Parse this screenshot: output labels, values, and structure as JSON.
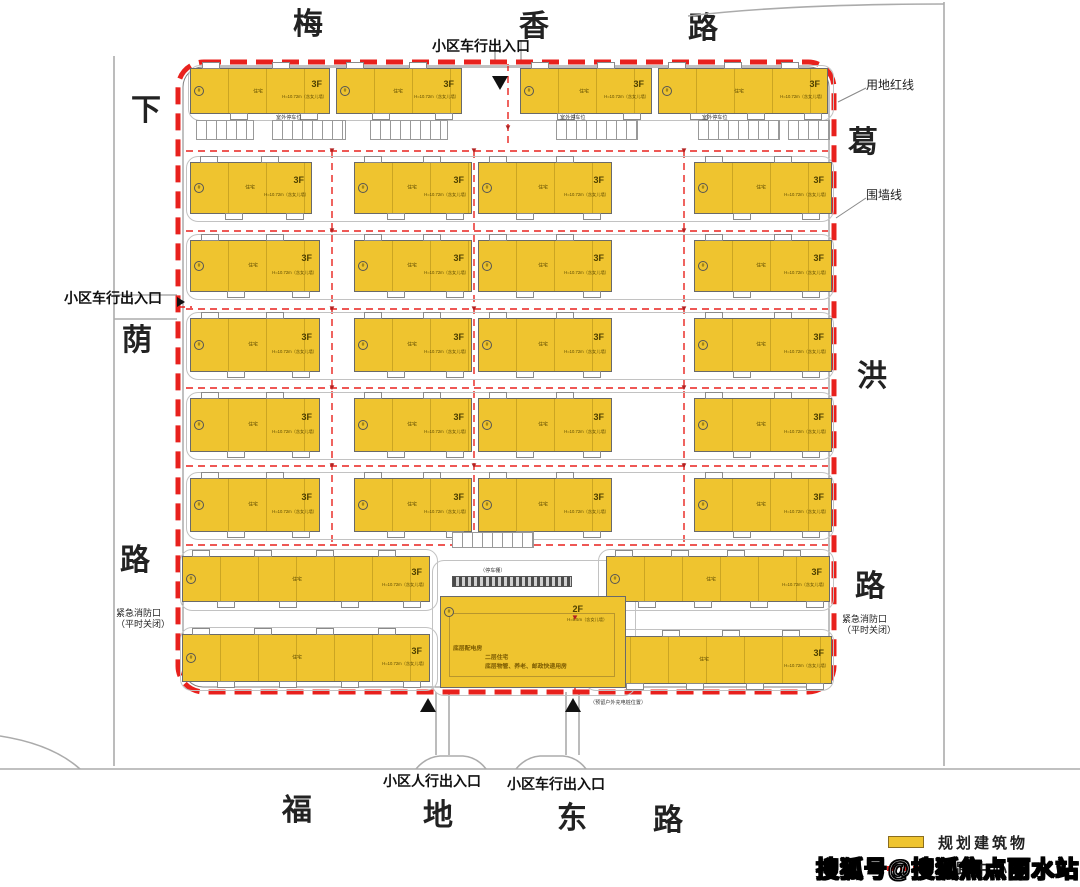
{
  "streets": {
    "top": [
      "梅",
      "香",
      "路"
    ],
    "left": [
      "下",
      "荫",
      "路"
    ],
    "right": [
      "葛",
      "洪",
      "路"
    ],
    "bottom": [
      "福",
      "地",
      "东",
      "路"
    ]
  },
  "annotations": {
    "entrance_vehicle_top": "小区车行出入口",
    "entrance_vehicle_left": "小区车行出入口",
    "entrance_pedestrian_bottom": "小区人行出入口",
    "entrance_vehicle_bottom": "小区车行出入口",
    "land_red_line": "用地红线",
    "wall_line": "围墙线",
    "emergency_exit": "紧急消防口",
    "emergency_exit_note": "（平时关闭）",
    "carport": "（停车棚）",
    "outdoor_parking": "室外停车位",
    "ev_charging": "（预留户外充电桩位置）"
  },
  "building_defaults": {
    "floors": "3F",
    "height": "H=10.72m（含女儿墙）",
    "type": "住宅",
    "marker": "#"
  },
  "central_building": {
    "floors": "2F",
    "height": "H=8.5m（含女儿墙）",
    "text1": "底层配电房",
    "text2": "二层住宅",
    "text3": "底层物管、养老、邮政快递用房"
  },
  "legend": {
    "items": [
      {
        "label": "规划建筑物"
      },
      {
        "label": "道路中心线"
      }
    ]
  },
  "watermark": "搜狐号@搜狐焦点丽水站",
  "colors": {
    "building_fill": "#EFC42F",
    "building_border": "#6A6A6A",
    "boundary_red": "#E8211D",
    "road_gray": "#ABABAB",
    "building_text": "#7A5A00"
  },
  "plan": {
    "boundary": {
      "x": 178,
      "y": 62,
      "w": 656,
      "h": 630,
      "r": 26
    },
    "wall": {
      "x": 183,
      "y": 67,
      "w": 646,
      "h": 620,
      "r": 20
    },
    "buildings": [
      {
        "x": 190,
        "y": 68,
        "w": 140,
        "h": 46
      },
      {
        "x": 336,
        "y": 68,
        "w": 126,
        "h": 46
      },
      {
        "x": 520,
        "y": 68,
        "w": 132,
        "h": 46
      },
      {
        "x": 658,
        "y": 68,
        "w": 170,
        "h": 46
      },
      {
        "x": 190,
        "y": 162,
        "w": 122,
        "h": 52
      },
      {
        "x": 354,
        "y": 162,
        "w": 118,
        "h": 52
      },
      {
        "x": 478,
        "y": 162,
        "w": 134,
        "h": 52
      },
      {
        "x": 694,
        "y": 162,
        "w": 138,
        "h": 52
      },
      {
        "x": 190,
        "y": 240,
        "w": 130,
        "h": 52
      },
      {
        "x": 354,
        "y": 240,
        "w": 118,
        "h": 52
      },
      {
        "x": 478,
        "y": 240,
        "w": 134,
        "h": 52
      },
      {
        "x": 694,
        "y": 240,
        "w": 138,
        "h": 52
      },
      {
        "x": 190,
        "y": 318,
        "w": 130,
        "h": 54
      },
      {
        "x": 354,
        "y": 318,
        "w": 118,
        "h": 54
      },
      {
        "x": 478,
        "y": 318,
        "w": 134,
        "h": 54
      },
      {
        "x": 694,
        "y": 318,
        "w": 138,
        "h": 54
      },
      {
        "x": 190,
        "y": 398,
        "w": 130,
        "h": 54
      },
      {
        "x": 354,
        "y": 398,
        "w": 118,
        "h": 54
      },
      {
        "x": 478,
        "y": 398,
        "w": 134,
        "h": 54
      },
      {
        "x": 694,
        "y": 398,
        "w": 138,
        "h": 54
      },
      {
        "x": 190,
        "y": 478,
        "w": 130,
        "h": 54
      },
      {
        "x": 354,
        "y": 478,
        "w": 118,
        "h": 54
      },
      {
        "x": 478,
        "y": 478,
        "w": 134,
        "h": 54
      },
      {
        "x": 694,
        "y": 478,
        "w": 138,
        "h": 54
      },
      {
        "x": 182,
        "y": 556,
        "w": 248,
        "h": 46
      },
      {
        "x": 606,
        "y": 556,
        "w": 224,
        "h": 46
      },
      {
        "x": 182,
        "y": 634,
        "w": 248,
        "h": 48
      },
      {
        "x": 592,
        "y": 636,
        "w": 240,
        "h": 48
      }
    ],
    "central": {
      "x": 440,
      "y": 596,
      "w": 186,
      "h": 92
    },
    "row_outlines": [
      {
        "x": 188,
        "y": 65,
        "w": 644,
        "h": 54
      },
      {
        "x": 186,
        "y": 156,
        "w": 646,
        "h": 64
      },
      {
        "x": 186,
        "y": 234,
        "w": 646,
        "h": 64
      },
      {
        "x": 186,
        "y": 312,
        "w": 646,
        "h": 66
      },
      {
        "x": 186,
        "y": 392,
        "w": 646,
        "h": 66
      },
      {
        "x": 186,
        "y": 472,
        "w": 646,
        "h": 66
      },
      {
        "x": 180,
        "y": 549,
        "w": 256,
        "h": 60
      },
      {
        "x": 598,
        "y": 549,
        "w": 234,
        "h": 60
      },
      {
        "x": 180,
        "y": 627,
        "w": 256,
        "h": 62
      },
      {
        "x": 584,
        "y": 629,
        "w": 248,
        "h": 60
      },
      {
        "x": 432,
        "y": 560,
        "w": 202,
        "h": 134
      }
    ],
    "h_centerlines": [
      {
        "y": 151,
        "x1": 186,
        "x2": 828
      },
      {
        "y": 231,
        "x1": 186,
        "x2": 828
      },
      {
        "y": 309,
        "x1": 186,
        "x2": 828
      },
      {
        "y": 388,
        "x1": 186,
        "x2": 828
      },
      {
        "y": 466,
        "x1": 186,
        "x2": 828
      },
      {
        "y": 545,
        "x1": 186,
        "x2": 828
      },
      {
        "y": 307,
        "x1": 178,
        "x2": 192
      }
    ],
    "v_centerlines": [
      {
        "x": 332,
        "y1": 151,
        "y2": 545
      },
      {
        "x": 474,
        "y1": 151,
        "y2": 545
      },
      {
        "x": 684,
        "y1": 151,
        "y2": 545
      },
      {
        "x": 508,
        "y1": 64,
        "y2": 148
      },
      {
        "x": 575,
        "y1": 600,
        "y2": 690
      }
    ],
    "parking": [
      {
        "x": 196,
        "y": 120,
        "w": 58,
        "h": 20
      },
      {
        "x": 272,
        "y": 120,
        "w": 74,
        "h": 20
      },
      {
        "x": 370,
        "y": 120,
        "w": 78,
        "h": 20
      },
      {
        "x": 556,
        "y": 120,
        "w": 82,
        "h": 20
      },
      {
        "x": 698,
        "y": 120,
        "w": 82,
        "h": 20
      },
      {
        "x": 788,
        "y": 120,
        "w": 42,
        "h": 20
      },
      {
        "x": 452,
        "y": 532,
        "w": 82,
        "h": 16
      }
    ],
    "parking_labels": [
      {
        "x": 276,
        "y": 113
      },
      {
        "x": 560,
        "y": 113
      },
      {
        "x": 702,
        "y": 113
      }
    ],
    "carport_strip": {
      "x": 452,
      "y": 576,
      "w": 120,
      "h": 11
    },
    "hydrants": [
      {
        "x": 332,
        "y": 151
      },
      {
        "x": 474,
        "y": 151
      },
      {
        "x": 684,
        "y": 151
      },
      {
        "x": 332,
        "y": 231
      },
      {
        "x": 684,
        "y": 231
      },
      {
        "x": 332,
        "y": 309
      },
      {
        "x": 474,
        "y": 309
      },
      {
        "x": 684,
        "y": 309
      },
      {
        "x": 332,
        "y": 388
      },
      {
        "x": 684,
        "y": 388
      },
      {
        "x": 332,
        "y": 466
      },
      {
        "x": 474,
        "y": 466
      },
      {
        "x": 684,
        "y": 466
      },
      {
        "x": 508,
        "y": 128
      },
      {
        "x": 575,
        "y": 618
      }
    ],
    "triangles": [
      {
        "x": 492,
        "y": 76,
        "dir": "down"
      },
      {
        "x": 420,
        "y": 698,
        "dir": "up"
      },
      {
        "x": 565,
        "y": 698,
        "dir": "up"
      },
      {
        "x": 177,
        "y": 297,
        "dir": "right"
      }
    ]
  }
}
